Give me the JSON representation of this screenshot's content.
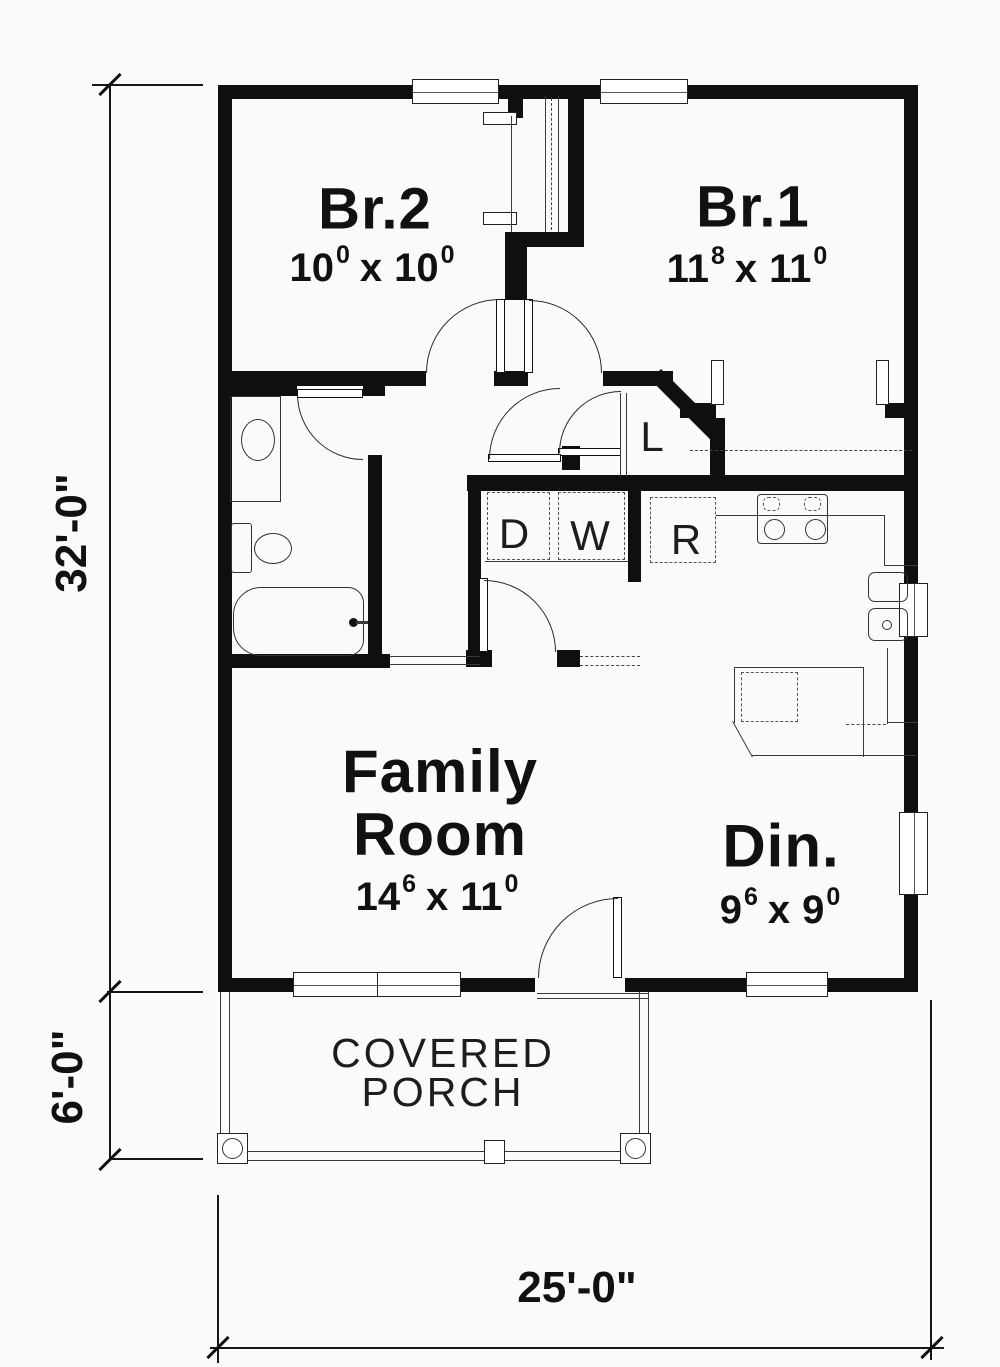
{
  "rooms": {
    "br2": {
      "name": "Br.2",
      "w": "10",
      "w_sup": "0",
      "sep": "x",
      "h": "10",
      "h_sup": "0"
    },
    "br1": {
      "name": "Br.1",
      "w": "11",
      "w_sup": "8",
      "sep": "x",
      "h": "11",
      "h_sup": "0"
    },
    "family": {
      "name_line1": "Family",
      "name_line2": "Room",
      "w": "14",
      "w_sup": "6",
      "sep": "x",
      "h": "11",
      "h_sup": "0"
    },
    "dining": {
      "name": "Din.",
      "w": "9",
      "w_sup": "6",
      "sep": "x",
      "h": "9",
      "h_sup": "0"
    },
    "porch": {
      "name_line1": "COVERED",
      "name_line2": "PORCH"
    }
  },
  "fixtures": {
    "dryer": "D",
    "washer": "W",
    "refrigerator": "R",
    "linen_closet": "L"
  },
  "dimensions": {
    "overall_height": "32'-0\"",
    "porch_height": "6'-0\"",
    "overall_width": "25'-0\""
  },
  "colors": {
    "wall": "#0f0f0f",
    "line": "#3a3a3a",
    "background": "#fafaf8",
    "text": "#111111"
  }
}
